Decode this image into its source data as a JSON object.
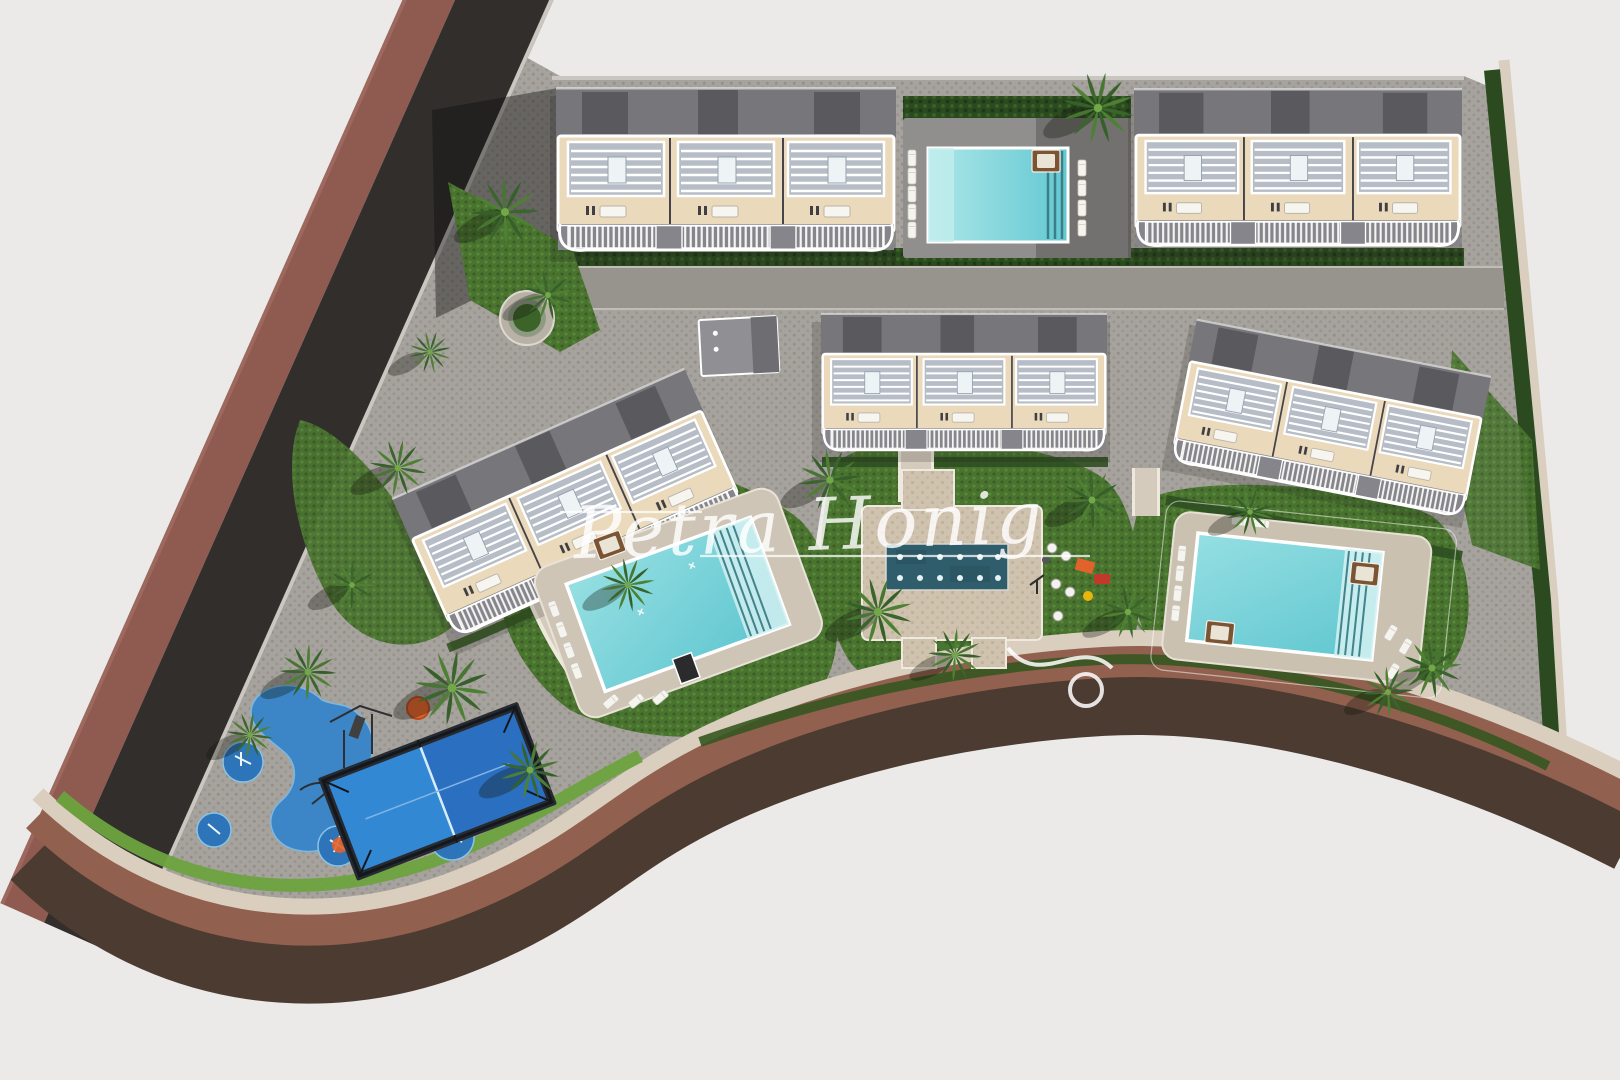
{
  "watermark": {
    "text": "Petra Honig"
  },
  "scene": {
    "type": "aerial-3d-architectural-site-plan-render",
    "counts": {
      "townhouse_blocks": 5,
      "swimming_pools": 3,
      "splash_pads": 1,
      "padel_courts": 1,
      "playgrounds": 2
    },
    "palette": {
      "background": "#ECEAE9",
      "asphalt_road": "#312E2C",
      "brick_sidewalk": "#8F5B51",
      "south_road_dark": "#4C3B30",
      "south_road_red": "#92604F",
      "gravel_edge": "#DACFBF",
      "cobble_pavers": "#A6A29D",
      "plaza_tan": "#CFC3AF",
      "walkway_beige": "#D5CBBC",
      "lawn_green": "#4A7330",
      "hedge_green": "#2C4A20",
      "palm_green": "#3A652C",
      "pool_water": "#7FD6DA",
      "pool_deck": "#CFC5B6",
      "splash_pad_teal": "#2F5D6C",
      "padel_blue": "#2A78C8",
      "play_surface_blue": "#3C86C8",
      "play_accent_orange": "#E2622B",
      "building_wall_cream": "#EAD9BA",
      "building_roof_grey": "#77777B",
      "roof_core_dark": "#5A5A5E",
      "white_trim": "#FFFFFF"
    },
    "features": [
      {
        "id": "perimeter-road-west",
        "label": "asphalt road with brick sidewalk, west boundary"
      },
      {
        "id": "perimeter-road-south",
        "label": "curved brown road, south boundary"
      },
      {
        "id": "site-pavement",
        "label": "grey cobblestone interior paving"
      },
      {
        "id": "townhouse-block-north-west",
        "label": "townhouse block, north-west"
      },
      {
        "id": "townhouse-block-north-east",
        "label": "townhouse block, north-east"
      },
      {
        "id": "townhouse-block-west",
        "label": "rotated townhouse block, west"
      },
      {
        "id": "townhouse-block-center",
        "label": "townhouse block, center"
      },
      {
        "id": "townhouse-block-east",
        "label": "rotated townhouse block, east"
      },
      {
        "id": "shared-pool-north",
        "label": "north shared pool with deck and loungers"
      },
      {
        "id": "main-pool-west",
        "label": "large rotated pool with lawn, west-center"
      },
      {
        "id": "pool-east",
        "label": "east pool with lawn and daybeds"
      },
      {
        "id": "splash-pad-plaza",
        "label": "central splash pad on tan plaza"
      },
      {
        "id": "playground-center",
        "label": "children playground with slide, center-east"
      },
      {
        "id": "playground-south-west",
        "label": "toddler playground, blue safety surface"
      },
      {
        "id": "padel-court",
        "label": "blue padel court with fence"
      },
      {
        "id": "circular-planter",
        "label": "round planter with palm"
      },
      {
        "id": "communal-structure",
        "label": "small flat-roof communal structure"
      },
      {
        "id": "palm-trees",
        "label": "palm trees with cast shadows"
      },
      {
        "id": "watermark",
        "label": "white script watermark"
      }
    ]
  }
}
